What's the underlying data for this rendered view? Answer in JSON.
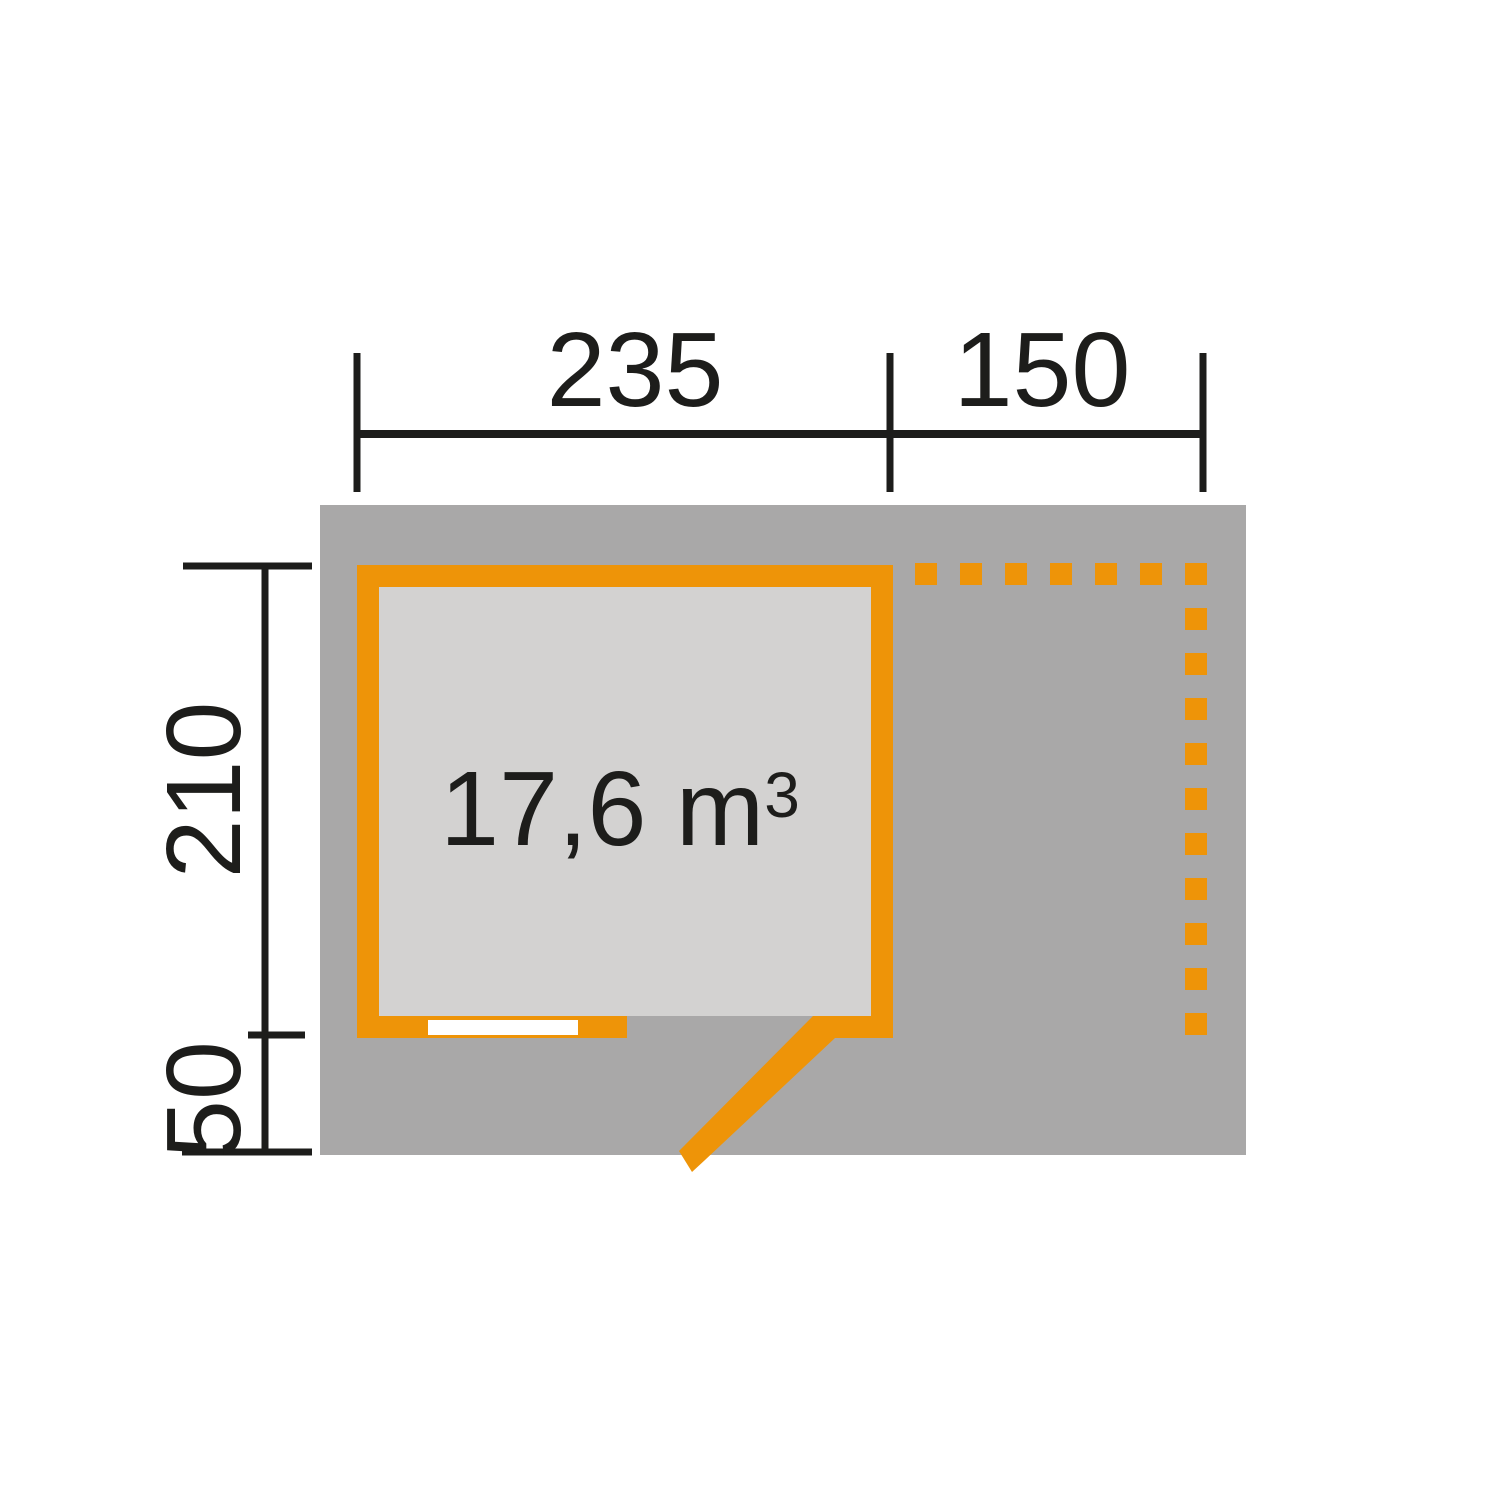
{
  "diagram": {
    "type": "garden-house-floor-plan",
    "labels": {
      "width_main": "235",
      "width_annex": "150",
      "depth_main": "210",
      "depth_annex": "50",
      "volume": "17,6 m",
      "volume_sup": "3"
    },
    "colors": {
      "wall_orange": "#EE9408",
      "roof_gray": "#A9A8A8",
      "floor_gray": "#D3D2D1",
      "line_black": "#1D1D1B",
      "window_white": "#FFFFFF",
      "background": "#FFFFFF"
    }
  }
}
